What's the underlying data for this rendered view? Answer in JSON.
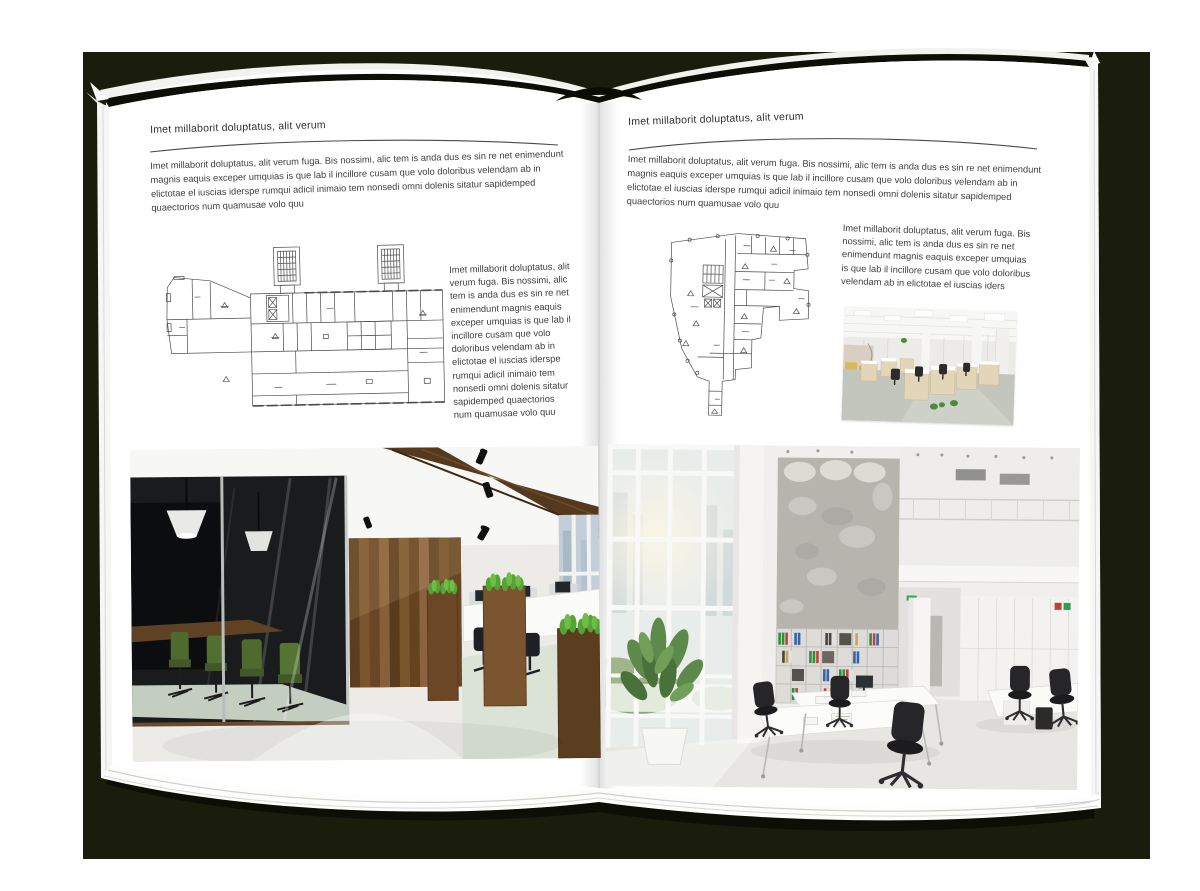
{
  "left_page": {
    "header": "Imet millaborit doluptatus, alit verum",
    "intro": "Imet millaborit doluptatus, alit verum fuga. Bis nossimi, alic tem is anda dus es sin re net enimendunt magnis eaquis exceper umquias is que lab il incillore cusam que volo doloribus velendam ab in elictotae el iuscias iderspe rumqui adicil inimaio tem nonsedi omni dolenis sitatur sapidemped quaectorios num quamusae volo quu",
    "caption": "Imet millaborit doluptatus, alit verum fuga. Bis nossimi, alic tem is anda dus es sin re net enimendunt magnis eaquis exceper umquias is que lab il incillore cusam que volo doloribus velendam ab in elictotae el iuscias iderspe rumqui adicil inimaio tem nonsedi omni dolenis sitatur sapidemped quaectorios num quamusae volo quu"
  },
  "right_page": {
    "header": "Imet millaborit doluptatus, alit verum",
    "intro": "Imet millaborit doluptatus, alit verum fuga. Bis nossimi, alic tem is anda dus es sin re net enimendunt magnis eaquis exceper umquias is que lab il incillore cusam que volo doloribus velendam ab in elictotae el iuscias iderspe rumqui adicil inimaio tem nonsedi omni dolenis sitatur sapidemped quaectorios num quamusae volo quu",
    "caption": "Imet millaborit doluptatus, alit verum fuga. Bis nossimi, alic tem is anda dus es sin re net enimendunt magnis eaquis exceper umquias is que lab il incillore cusam que volo doloribus velendam ab in elictotae el iuscias iders"
  },
  "colors": {
    "backdrop": "#1a1c0c",
    "page": "#ffffff",
    "text": "#3e3e3e",
    "plan_line": "#4b4b4b"
  }
}
